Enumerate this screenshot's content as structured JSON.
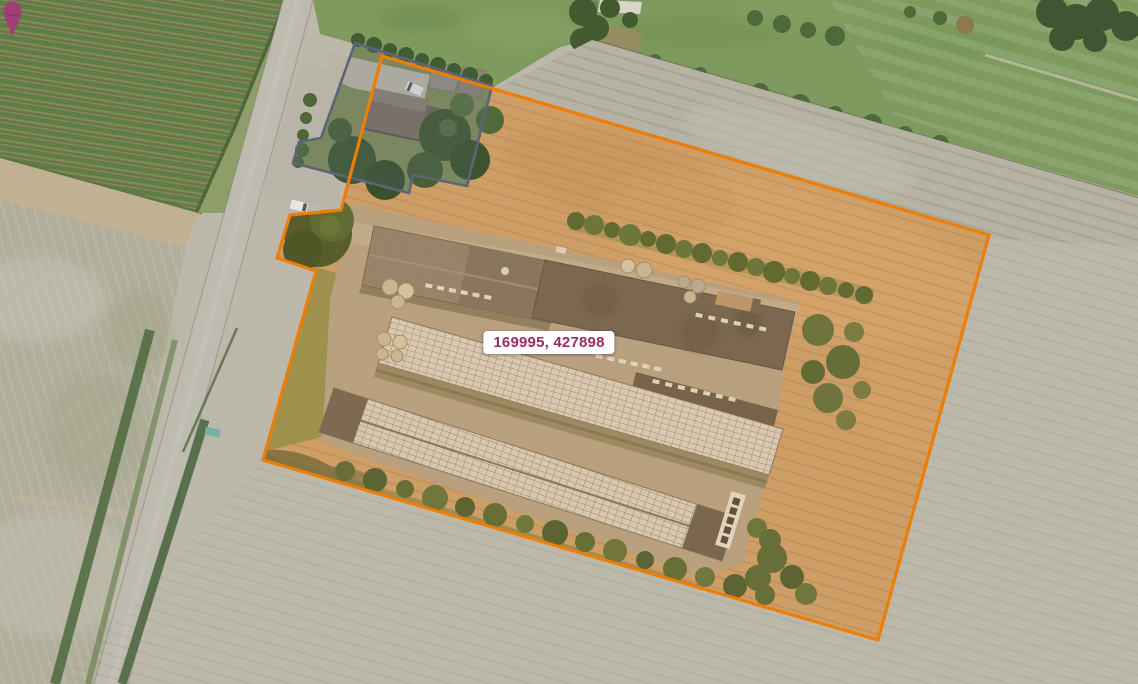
{
  "map_view": {
    "type": "aerial-imagery",
    "coordinate_tooltip": {
      "text": "169995, 427898",
      "text_color": "#9b2c66",
      "background": "#ffffff"
    },
    "marker": {
      "name": "location-pin",
      "color": "#a23a78"
    },
    "selected_parcel": {
      "outline_color": "#ee7d05",
      "fill_tint": "rgba(238,124,0,0.12)"
    },
    "building_parcel_outline": {
      "outline_color": "#5a6377",
      "fill_tint": "rgba(100,112,140,0.16)"
    }
  }
}
